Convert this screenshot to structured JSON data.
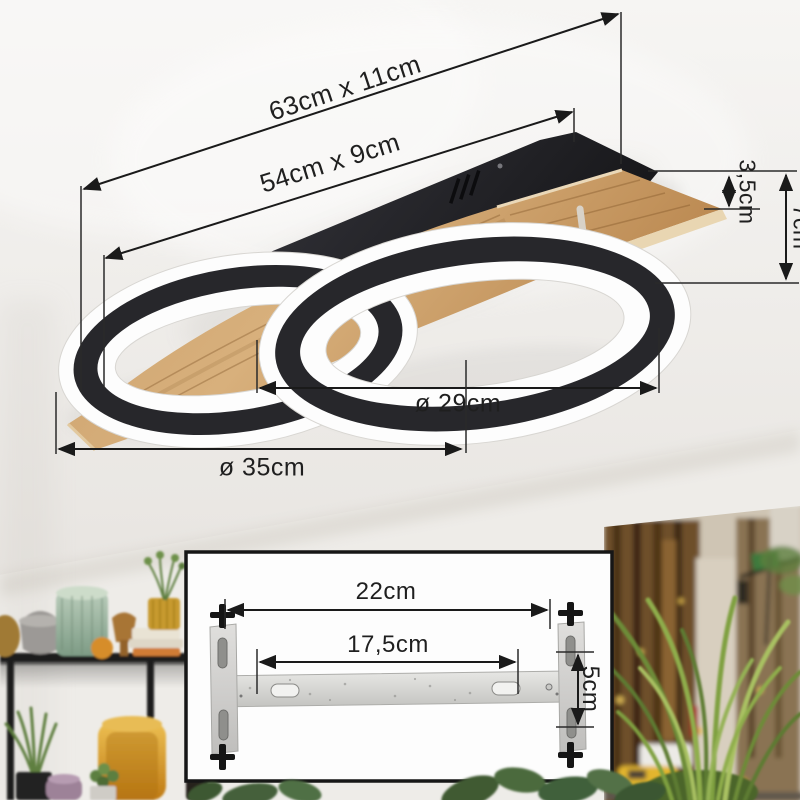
{
  "product_diagram": {
    "dimensions": {
      "overall": "63cm x 11cm",
      "base_plate": "54cm x 9cm",
      "wood_thickness": "3,5cm",
      "fixture_height": "7cm",
      "ring_right_diameter": "ø 29cm",
      "ring_left_diameter": "ø 35cm"
    }
  },
  "mounting_bracket_inset": {
    "dimensions": {
      "outer_width": "22cm",
      "hole_spacing": "17,5cm",
      "bracket_height": "5cm"
    }
  },
  "colors": {
    "dimension_line": "#1a1a1a",
    "lamp_black": "#27272b",
    "lamp_white": "#fdfdfd",
    "wood": "#c89b6a",
    "bracket_metal": "#d9d9d6",
    "inset_background": "#fdfdfd",
    "inset_border": "#161616",
    "wall": "#f1efec"
  }
}
